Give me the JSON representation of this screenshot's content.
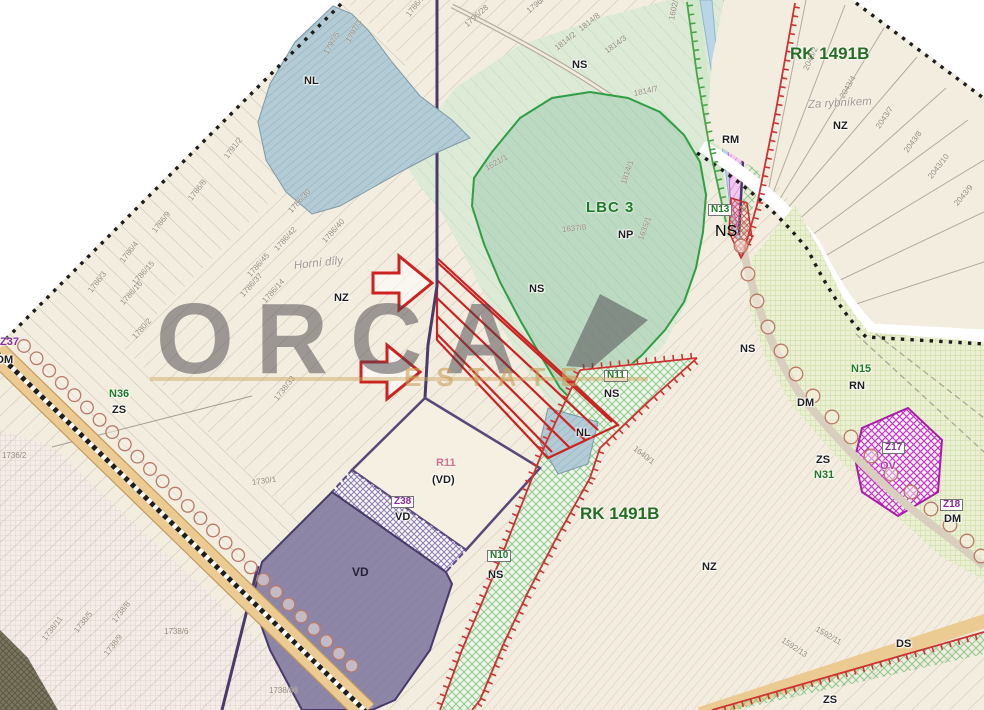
{
  "watermark": {
    "line1": "ORCA",
    "line2": "ESTATE"
  },
  "colors": {
    "paper_cream": "#f3ede0",
    "outside_white": "#ffffff",
    "boundary_dots": "#1c1c1c",
    "zone_green_text": "#1f7a28",
    "red_plan": "#cc2222",
    "purple_line": "#4a3a6a",
    "vd_purple_fill": "#8e86a7",
    "magenta_zone": "#c637c6",
    "lbc_green": "#bcd9c2",
    "ns_green": "#dcead6",
    "lime_grid": "#ecf0d3",
    "road_tan": "#eccb92",
    "water_blue": "#b9d6e6"
  },
  "labels": [
    {
      "t": "NL",
      "x": 304,
      "y": 76,
      "r": 0,
      "c": "z"
    },
    {
      "t": "NS",
      "x": 572,
      "y": 60,
      "r": 0,
      "c": "z"
    },
    {
      "t": "NS",
      "x": 529,
      "y": 284,
      "r": 0,
      "c": "z"
    },
    {
      "t": "NP",
      "x": 618,
      "y": 230,
      "r": 0,
      "c": "z"
    },
    {
      "t": "NZ",
      "x": 334,
      "y": 293,
      "r": 0,
      "c": "z"
    },
    {
      "t": "NZ",
      "x": 833,
      "y": 121,
      "r": 0,
      "c": "z"
    },
    {
      "t": "NZ",
      "x": 702,
      "y": 562,
      "r": 0,
      "c": "z"
    },
    {
      "t": "RM",
      "x": 722,
      "y": 135,
      "r": 0,
      "c": "z"
    },
    {
      "t": "RN",
      "x": 849,
      "y": 381,
      "r": 0,
      "c": "z"
    },
    {
      "t": "DM",
      "x": -4,
      "y": 355,
      "r": 0,
      "c": "z"
    },
    {
      "t": "DM",
      "x": 797,
      "y": 398,
      "r": 0,
      "c": "z"
    },
    {
      "t": "DM",
      "x": 944,
      "y": 514,
      "r": 0,
      "c": "z"
    },
    {
      "t": "ZS",
      "x": 112,
      "y": 405,
      "r": 0,
      "c": "z"
    },
    {
      "t": "ZS",
      "x": 816,
      "y": 455,
      "r": 0,
      "c": "z"
    },
    {
      "t": "ZS",
      "x": 823,
      "y": 695,
      "r": 0,
      "c": "z"
    },
    {
      "t": "NS",
      "x": 740,
      "y": 344,
      "r": 0,
      "c": "z"
    },
    {
      "t": "NS",
      "x": 715,
      "y": 224,
      "r": 0,
      "c": "zb"
    },
    {
      "t": "NS",
      "x": 604,
      "y": 389,
      "r": 0,
      "c": "z"
    },
    {
      "t": "NS",
      "x": 488,
      "y": 570,
      "r": 0,
      "c": "z"
    },
    {
      "t": "NL",
      "x": 576,
      "y": 428,
      "r": 0,
      "c": "z"
    },
    {
      "t": "VD",
      "x": 352,
      "y": 566,
      "r": 0,
      "c": "vdl"
    },
    {
      "t": "VD",
      "x": 395,
      "y": 512,
      "r": 0,
      "c": "z"
    },
    {
      "t": "(VD)",
      "x": 432,
      "y": 475,
      "r": 0,
      "c": "z"
    },
    {
      "t": "DS",
      "x": 896,
      "y": 639,
      "r": 0,
      "c": "z"
    },
    {
      "t": "OV",
      "x": 880,
      "y": 461,
      "r": 0,
      "c": "mg"
    },
    {
      "t": "N36",
      "x": 109,
      "y": 389,
      "r": 0,
      "c": "g"
    },
    {
      "t": "N15",
      "x": 851,
      "y": 364,
      "r": 0,
      "c": "g"
    },
    {
      "t": "N31",
      "x": 814,
      "y": 470,
      "r": 0,
      "c": "g"
    },
    {
      "t": "N13",
      "x": 708,
      "y": 204,
      "r": 0,
      "c": "gb"
    },
    {
      "t": "N11",
      "x": 604,
      "y": 370,
      "r": 0,
      "c": "gb"
    },
    {
      "t": "N10",
      "x": 487,
      "y": 550,
      "r": 0,
      "c": "gb"
    },
    {
      "t": "Z38",
      "x": 391,
      "y": 496,
      "r": 0,
      "c": "pb"
    },
    {
      "t": "Z18",
      "x": 940,
      "y": 499,
      "r": 0,
      "c": "pb"
    },
    {
      "t": "Z17",
      "x": 882,
      "y": 442,
      "r": 0,
      "c": "pb"
    },
    {
      "t": "Z37",
      "x": 0,
      "y": 337,
      "r": 0,
      "c": "p"
    },
    {
      "t": "R11",
      "x": 436,
      "y": 458,
      "r": 0,
      "c": "pk"
    },
    {
      "t": "LBC 3",
      "x": 586,
      "y": 200,
      "r": 0,
      "c": "big"
    },
    {
      "t": "RK 1491B",
      "x": 790,
      "y": 45,
      "r": 0,
      "c": "big2"
    },
    {
      "t": "RK 1491B",
      "x": 580,
      "y": 505,
      "r": 0,
      "c": "big2"
    },
    {
      "t": "Horní díly",
      "x": 294,
      "y": 261,
      "r": -6,
      "c": "it"
    },
    {
      "t": "Za rybníkem",
      "x": 808,
      "y": 100,
      "r": -3,
      "c": "it"
    }
  ],
  "parcels": [
    {
      "t": "1797/3",
      "x": 348,
      "y": 38,
      "r": -60
    },
    {
      "t": "1797/5",
      "x": 326,
      "y": 50,
      "r": -60
    },
    {
      "t": "1786/19",
      "x": 408,
      "y": 12,
      "r": -52
    },
    {
      "t": "1796/28",
      "x": 466,
      "y": 22,
      "r": -42
    },
    {
      "t": "1796/19",
      "x": 528,
      "y": 8,
      "r": -40
    },
    {
      "t": "1814/8",
      "x": 580,
      "y": 26,
      "r": -38
    },
    {
      "t": "1814/2",
      "x": 556,
      "y": 45,
      "r": -38
    },
    {
      "t": "1814/3",
      "x": 606,
      "y": 48,
      "r": -36
    },
    {
      "t": "1602/3",
      "x": 672,
      "y": 16,
      "r": -78
    },
    {
      "t": "1814/7",
      "x": 634,
      "y": 90,
      "r": -12
    },
    {
      "t": "1637/8",
      "x": 562,
      "y": 226,
      "r": -6
    },
    {
      "t": "1621/1",
      "x": 486,
      "y": 165,
      "r": -30
    },
    {
      "t": "1814/1",
      "x": 624,
      "y": 180,
      "r": -72
    },
    {
      "t": "1635/1",
      "x": 641,
      "y": 236,
      "r": -70
    },
    {
      "t": "1791/2",
      "x": 226,
      "y": 154,
      "r": -52
    },
    {
      "t": "1786/8",
      "x": 190,
      "y": 196,
      "r": -52
    },
    {
      "t": "1786/9",
      "x": 154,
      "y": 228,
      "r": -52
    },
    {
      "t": "1786/4",
      "x": 122,
      "y": 258,
      "r": -52
    },
    {
      "t": "1786/3",
      "x": 90,
      "y": 288,
      "r": -52
    },
    {
      "t": "1786/30",
      "x": 290,
      "y": 208,
      "r": -48
    },
    {
      "t": "1786/40",
      "x": 324,
      "y": 238,
      "r": -48
    },
    {
      "t": "1786/42",
      "x": 276,
      "y": 246,
      "r": -48
    },
    {
      "t": "1786/45",
      "x": 249,
      "y": 272,
      "r": -48
    },
    {
      "t": "1786/37",
      "x": 242,
      "y": 292,
      "r": -48
    },
    {
      "t": "1786/15",
      "x": 134,
      "y": 280,
      "r": -48
    },
    {
      "t": "1786/16",
      "x": 122,
      "y": 300,
      "r": -48
    },
    {
      "t": "1786/14",
      "x": 264,
      "y": 298,
      "r": -48
    },
    {
      "t": "1780/2",
      "x": 134,
      "y": 334,
      "r": -48
    },
    {
      "t": "1736/2",
      "x": 2,
      "y": 452,
      "r": 0
    },
    {
      "t": "1730/1",
      "x": 252,
      "y": 479,
      "r": -8
    },
    {
      "t": "1738/33",
      "x": 276,
      "y": 396,
      "r": -52
    },
    {
      "t": "1738/5",
      "x": 76,
      "y": 628,
      "r": -52
    },
    {
      "t": "1738/8",
      "x": 114,
      "y": 618,
      "r": -52
    },
    {
      "t": "1738/9",
      "x": 106,
      "y": 651,
      "r": -52
    },
    {
      "t": "1738/11",
      "x": 44,
      "y": 636,
      "r": -52
    },
    {
      "t": "1738/6",
      "x": 164,
      "y": 628,
      "r": 0
    },
    {
      "t": "1738/86",
      "x": 269,
      "y": 687,
      "r": 0
    },
    {
      "t": "1640/1",
      "x": 634,
      "y": 444,
      "r": 38
    },
    {
      "t": "1592/11",
      "x": 816,
      "y": 625,
      "r": 30
    },
    {
      "t": "1592/13",
      "x": 782,
      "y": 636,
      "r": 33
    },
    {
      "t": "2043/2",
      "x": 806,
      "y": 66,
      "r": -66
    },
    {
      "t": "2043/4",
      "x": 842,
      "y": 94,
      "r": -60
    },
    {
      "t": "2043/7",
      "x": 878,
      "y": 124,
      "r": -56
    },
    {
      "t": "2043/8",
      "x": 906,
      "y": 148,
      "r": -54
    },
    {
      "t": "2043/10",
      "x": 930,
      "y": 174,
      "r": -52
    },
    {
      "t": "2043/9",
      "x": 956,
      "y": 201,
      "r": -50
    }
  ]
}
